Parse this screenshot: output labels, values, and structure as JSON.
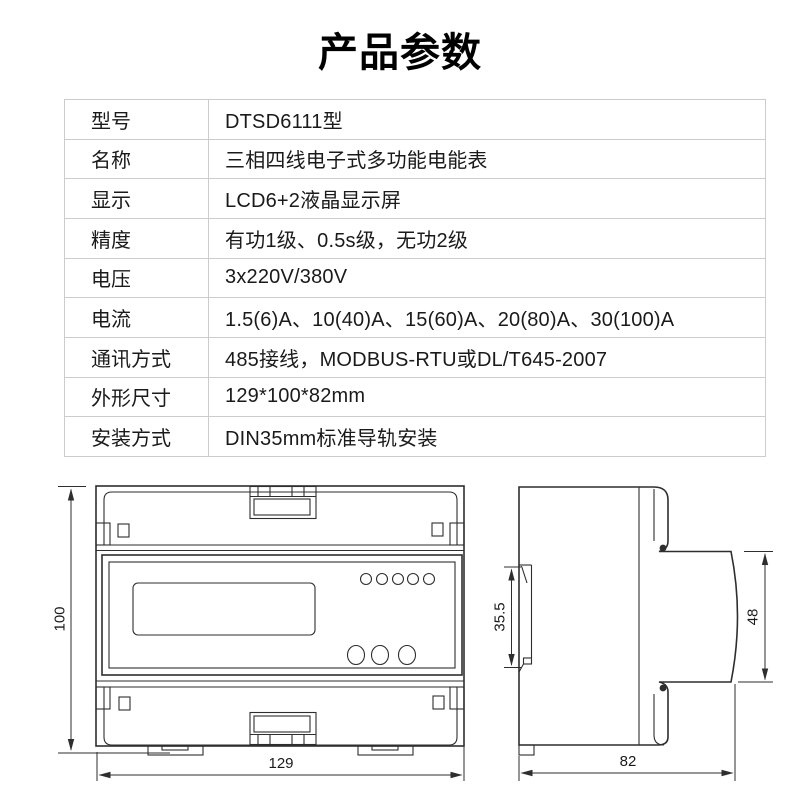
{
  "page": {
    "title": "产品参数"
  },
  "specs": [
    {
      "label": "型号",
      "value": "DTSD6111型"
    },
    {
      "label": "名称",
      "value": "三相四线电子式多功能电能表"
    },
    {
      "label": "显示",
      "value": "LCD6+2液晶显示屏"
    },
    {
      "label": "精度",
      "value": "有功1级、0.5s级，无功2级"
    },
    {
      "label": "电压",
      "value": "3x220V/380V"
    },
    {
      "label": "电流",
      "value": "1.5(6)A、10(40)A、15(60)A、20(80)A、30(100)A"
    },
    {
      "label": "通讯方式",
      "value": "485接线，MODBUS-RTU或DL/T645-2007"
    },
    {
      "label": "外形尺寸",
      "value": "129*100*82mm"
    },
    {
      "label": "安装方式",
      "value": "DIN35mm标准导轨安装"
    }
  ],
  "drawing": {
    "front_view": {
      "height_mm": "100",
      "width_mm": "129"
    },
    "side_view": {
      "rail_mm": "35.5",
      "face_mm": "48",
      "depth_mm": "82"
    }
  },
  "colors": {
    "table_border": "#cccccc",
    "line": "#2e2e2e",
    "text": "#1a1a1a"
  }
}
